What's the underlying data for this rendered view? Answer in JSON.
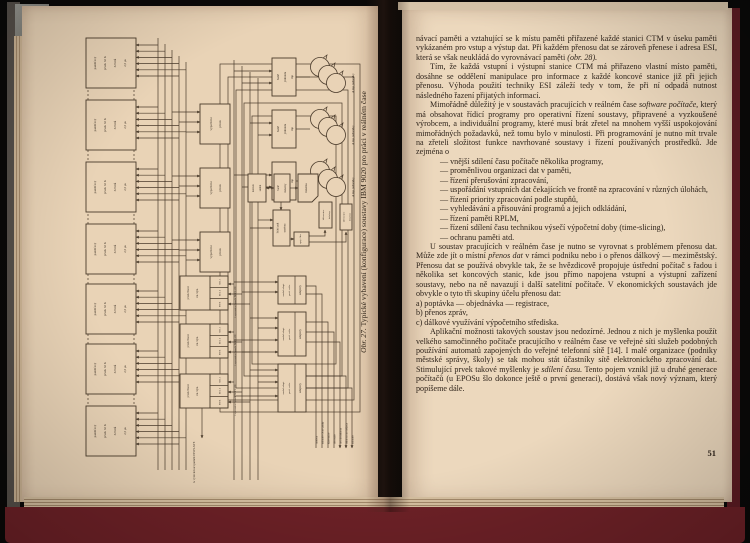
{
  "photo": {
    "background_color": "#0a0908",
    "cover_color": "#6e2127",
    "left_page_color": "#e9d3b6",
    "right_page_color": "#ecd8bd",
    "ink_color": "#3a2f24"
  },
  "figure_page": {
    "caption_prefix": "Obr. 27.",
    "caption": "Typické vybavení (konfigurace) soustavy IBM 9020 pro práci v reálném čase",
    "diagram": {
      "memory_box_lines": [
        "paměťový",
        "prvek 32 K",
        "32 bitů",
        "2,5 μs"
      ],
      "compute_box_lines": [
        "výpočetní",
        "prvek"
      ],
      "io_box_lines": [
        "prvek řízení",
        "vst./výst."
      ],
      "io_cells": [
        "SEL 1",
        "SEL 2",
        "MPX"
      ],
      "tape_controller_lines": [
        "řadič",
        "jednotek",
        "mp"
      ],
      "tape_units_label": "4 mp jednotky",
      "console_lines": [
        "konzol.",
        "stolek"
      ],
      "printer_controller_lines": [
        "řadič",
        "tiskárny"
      ],
      "printer_label": "tiskárna",
      "control_desk_lines": [
        "řídicí pult",
        "systému"
      ],
      "connector_label": "spoj. člen",
      "keyboard_printer_lines": [
        "klávesnice",
        "tiskárny"
      ],
      "adapter_module_lines": [
        "modul adapt.",
        "perif. zaříz."
      ],
      "adapters_label": "adaptéry",
      "display_buffer_label": "k vyrovnávací paměti DISPLAYE",
      "peripheral_labels": [
        "modem",
        "snímače děrné pásky",
        "klávesnice",
        "děrovače",
        "rychlá tiskárna",
        "tiskárna na doklady",
        "snímače"
      ]
    }
  },
  "text_page": {
    "page_number": "51",
    "blocks": [
      {
        "type": "cont",
        "runs": [
          {
            "t": "návací paměti a vztahující se k místu paměti přiřazené každé stanici CTM v úseku paměti vykázaném pro vstup a výstup dat. Při každém přenosu dat se zároveň přenese i adresa ESI, která se však neukládá do vyrovnávací paměti "
          },
          {
            "t": "(obr. 28).",
            "i": true
          }
        ]
      },
      {
        "type": "para",
        "runs": [
          {
            "t": "Tím, že každá vstupní i výstupní stanice CTM má přiřazeno vlastní místo paměti, dosáhne se oddělení manipulace pro informace z každé koncové stanice již při jejich přenosu. Výhoda použití techniky ESI záleží tedy v tom, že při ní odpadá nutnost následného řazení přijatých informací."
          }
        ]
      },
      {
        "type": "para",
        "runs": [
          {
            "t": "Mimořádně důležitý je v soustavách pracujících v reálném čase "
          },
          {
            "t": "software počítače,",
            "i": true
          },
          {
            "t": " který má obsahovat řídicí programy pro operativní řízení soustavy, připravené a vyzkoušené výrobcem, a individuální programy, které musí brát zřetel na mnohem vyšší uspokojování mimořádných požadavků, než tomu bylo v minulosti. Při programování je nutno mít trvale na zřeteli složitost funkce navrhované soustavy i řízení používaných prostředků. Jde zejména o"
          }
        ]
      },
      {
        "type": "dash",
        "runs": [
          {
            "t": "— vnější sdílení času počítače několika programy,"
          }
        ]
      },
      {
        "type": "dash",
        "runs": [
          {
            "t": "— proměnlivou organizaci dat v paměti,"
          }
        ]
      },
      {
        "type": "dash",
        "runs": [
          {
            "t": "— řízení přerušování zpracování,"
          }
        ]
      },
      {
        "type": "dashwrap",
        "runs": [
          {
            "t": "— uspořádání vstupních dat čekajících ve frontě na zpracování v různých úlohách,"
          }
        ]
      },
      {
        "type": "dash",
        "runs": [
          {
            "t": "— řízení priority zpracování podle stupňů,"
          }
        ]
      },
      {
        "type": "dash",
        "runs": [
          {
            "t": "— vyhledávání a přisouvání programů a jejich odkládání,"
          }
        ]
      },
      {
        "type": "dash",
        "runs": [
          {
            "t": "— řízení paměti RPLM,"
          }
        ]
      },
      {
        "type": "dash",
        "runs": [
          {
            "t": "— řízení sdílení času technikou výsečí výpočetní doby (time-slicing),"
          }
        ]
      },
      {
        "type": "dash",
        "runs": [
          {
            "t": "— ochranu paměti atd."
          }
        ]
      },
      {
        "type": "para",
        "runs": [
          {
            "t": "U soustav pracujících v reálném čase je nutno se vyrovnat s problémem přenosu dat. Může zde jít o místní "
          },
          {
            "t": "přenos dat",
            "i": true
          },
          {
            "t": " v rámci podniku nebo i o přenos dálkový — meziměstský. Přenosu dat se používá obvykle tak, že se hvězdicově propojuje ústřední počítač s řadou i několika set koncových stanic, kde jsou přímo napojena vstupní a výstupní zařízení soustavy, nebo na ně navazují i další satelitní počítače. V ekonomických soustavách jde obvykle o tyto tři skupiny účelu přenosu dat:"
          }
        ]
      },
      {
        "type": "alpha",
        "runs": [
          {
            "t": "a) poptávka — objednávka — registrace,"
          }
        ]
      },
      {
        "type": "alpha",
        "runs": [
          {
            "t": "b) přenos zpráv,"
          }
        ]
      },
      {
        "type": "alpha",
        "runs": [
          {
            "t": "c) dálkové využívání výpočetního střediska."
          }
        ]
      },
      {
        "type": "para",
        "runs": [
          {
            "t": "Aplikační možnosti takových soustav jsou nedozírné. Jednou z nich je myšlenka použít velkého samočinného počítače pracujícího v reálném čase ve veřejné síti služeb podobných používání automatů zapojených do veřejné telefonní sítě [14]. I malé organizace (podniky městské správy, školy) se tak mohou stát účastníky sítě elektronického zpracování dat. Stimulující prvek takové myšlenky je "
          },
          {
            "t": "sdílení času.",
            "i": true
          },
          {
            "t": " Tento pojem vznikl již u druhé generace počítačů (u EPOSu šlo dokonce ještě o první generaci), dostává však nový význam, který popíšeme dále."
          }
        ]
      }
    ]
  }
}
